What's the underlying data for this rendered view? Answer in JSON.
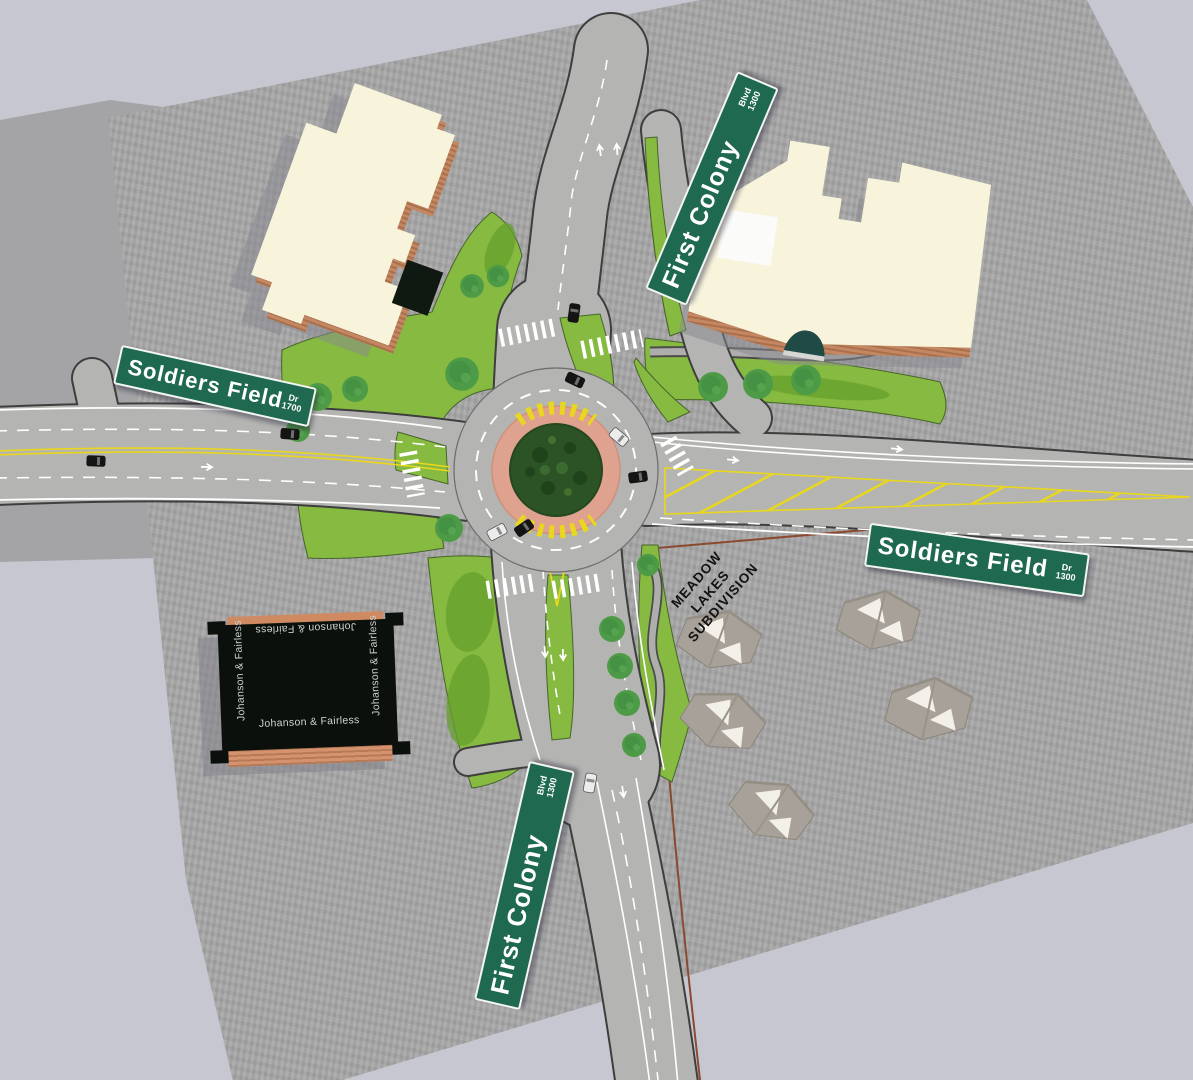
{
  "scene": {
    "signs": {
      "soldiers_field_west": {
        "street": "Soldiers Field",
        "suffix": "Dr",
        "block": "1700"
      },
      "soldiers_field_east": {
        "street": "Soldiers Field",
        "suffix": "Dr",
        "block": "1300"
      },
      "first_colony_north": {
        "street": "First Colony",
        "suffix": "Blvd",
        "block": "1300"
      },
      "first_colony_south": {
        "street": "First Colony",
        "suffix": "Blvd",
        "block": "1300"
      }
    },
    "subdivision_label": {
      "line1": "MEADOW",
      "line2": "LAKES",
      "line3": "SUBDIVISION"
    },
    "building_label": "Johanson & Fairless",
    "colors": {
      "background": "#c6c7d1",
      "ground": "#a7a7a7",
      "road": "#b4b4b2",
      "grass": "#87ba41",
      "tree": "#4e9b47",
      "center_island": "#2c5326",
      "truck_apron": "#dfa28f",
      "marking_yellow": "#e8d71c",
      "sign_green": "#1e6950",
      "roof_cream": "#f8f4dc",
      "brick_wall": "#c08058",
      "dark_roof": "#0c100c"
    }
  }
}
